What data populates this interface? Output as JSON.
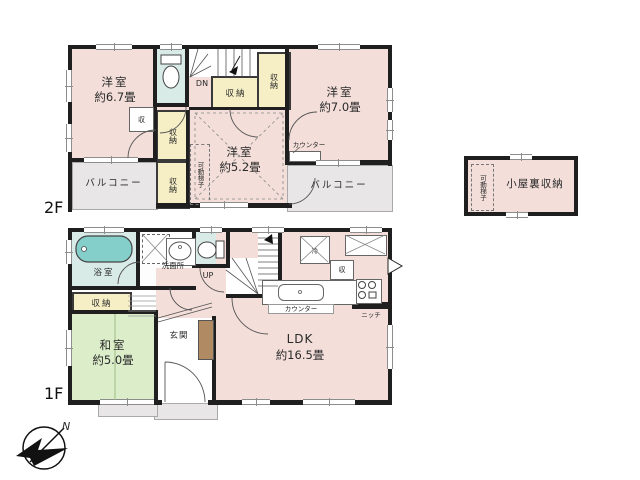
{
  "colors": {
    "wall": "#1f1f1f",
    "room": "#f3ded9",
    "closet": "#f6efc5",
    "bath": "#d8ebe7",
    "tatami": "#dcedca",
    "balcony": "#e8e6e7",
    "tub": "#85cfcb",
    "cabinet": "#b08a63"
  },
  "compass": {
    "north_label": "N"
  },
  "floor2": {
    "floor_label": "2F",
    "rooms": {
      "bedroom67": {
        "name": "洋室",
        "size": "約6.7畳"
      },
      "bedroom70": {
        "name": "洋室",
        "size": "約7.0畳"
      },
      "bedroom52": {
        "name": "洋室",
        "size": "約5.2畳"
      },
      "balcony_left": "バルコニー",
      "balcony_right": "バルコニー"
    },
    "labels": {
      "closet": "収納",
      "closet_small": "収",
      "down": "DN",
      "counter": "カウンター",
      "ladder": "可動梯子"
    }
  },
  "attic": {
    "name": "小屋裏収納",
    "ladder": "可動梯子"
  },
  "floor1": {
    "floor_label": "1F",
    "rooms": {
      "bath": "浴室",
      "washroom": "洗面所",
      "storage": "収納",
      "washitsu": {
        "name": "和室",
        "size": "約5.0畳"
      },
      "genkan": "玄関",
      "ldk": {
        "name": "LDK",
        "size": "約16.5畳"
      }
    },
    "labels": {
      "up": "UP",
      "counter": "カウンター",
      "niche": "ニッチ",
      "fridge": "冷",
      "closet_small": "収"
    }
  }
}
